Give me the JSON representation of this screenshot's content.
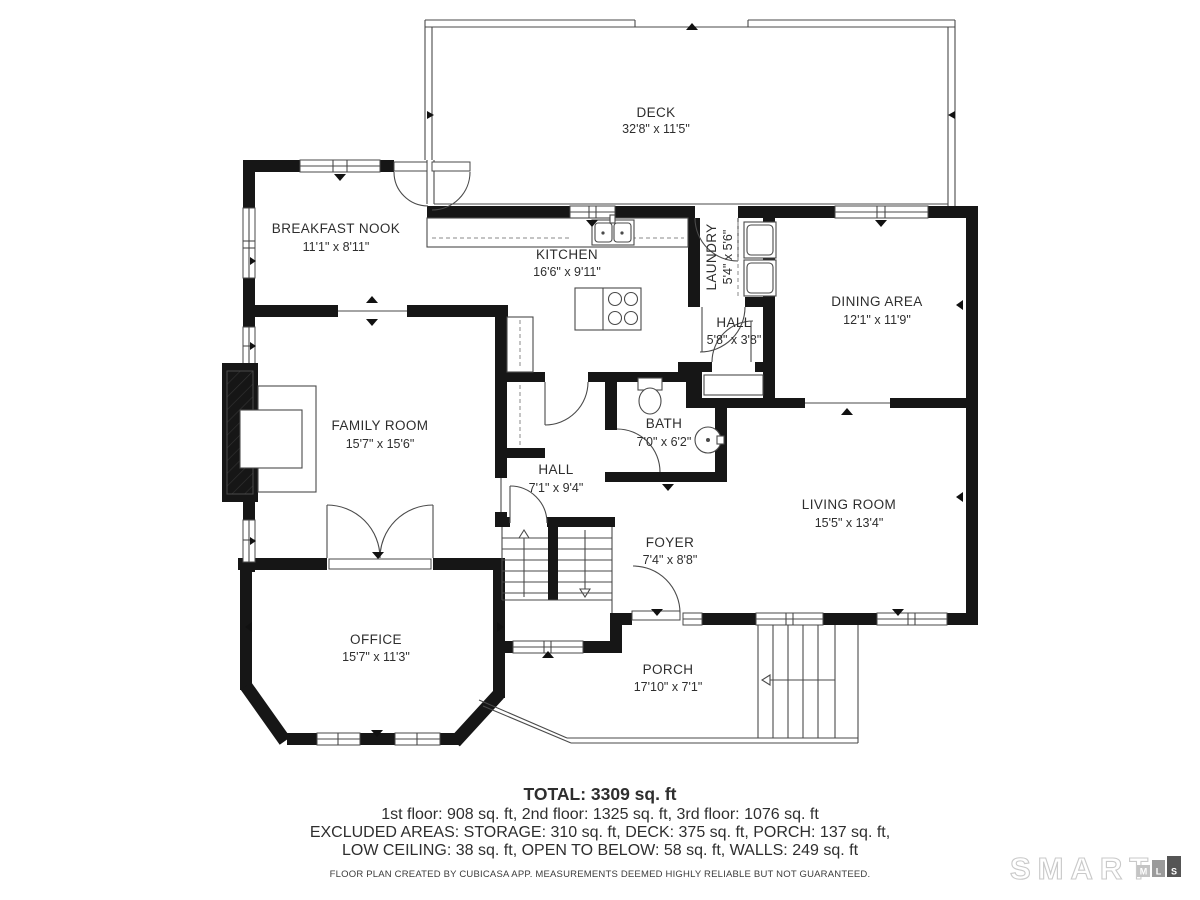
{
  "rooms": [
    {
      "name": "DECK",
      "dims": "32'8\" x 11'5\""
    },
    {
      "name": "BREAKFAST NOOK",
      "dims": "11'1\" x 8'11\""
    },
    {
      "name": "KITCHEN",
      "dims": "16'6\" x 9'11\""
    },
    {
      "name": "LAUNDRY",
      "dims": "5'4\" x 5'6\""
    },
    {
      "name": "DINING AREA",
      "dims": "12'1\" x 11'9\""
    },
    {
      "name": "HALL",
      "dims": "5'8\" x 3'8\""
    },
    {
      "name": "FAMILY ROOM",
      "dims": "15'7\" x 15'6\""
    },
    {
      "name": "BATH",
      "dims": "7'0\" x 6'2\""
    },
    {
      "name": "HALL",
      "dims": "7'1\" x 9'4\""
    },
    {
      "name": "LIVING ROOM",
      "dims": "15'5\" x 13'4\""
    },
    {
      "name": "FOYER",
      "dims": "7'4\" x 8'8\""
    },
    {
      "name": "OFFICE",
      "dims": "15'7\" x 11'3\""
    },
    {
      "name": "PORCH",
      "dims": "17'10\" x 7'1\""
    }
  ],
  "summary": {
    "total": "TOTAL: 3309 sq. ft",
    "floors": "1st floor: 908 sq. ft, 2nd floor: 1325 sq. ft, 3rd floor: 1076 sq. ft",
    "excluded1": "EXCLUDED AREAS: STORAGE: 310 sq. ft, DECK: 375 sq. ft, PORCH: 137 sq. ft,",
    "excluded2": "LOW CEILING: 38 sq. ft, OPEN TO BELOW: 58 sq. ft, WALLS: 249 sq. ft",
    "disclaimer": "FLOOR PLAN CREATED BY CUBICASA APP. MEASUREMENTS DEEMED HIGHLY RELIABLE BUT NOT GUARANTEED."
  },
  "branding": {
    "name": "SMART",
    "m": "M",
    "l": "L",
    "s": "S"
  },
  "colors": {
    "wall": "#161616",
    "line": "#4a4a4a",
    "text": "#2e2e2e",
    "logo_light": "#c9c9c9",
    "logo_mid": "#9b9b9b",
    "logo_dark": "#555555"
  }
}
